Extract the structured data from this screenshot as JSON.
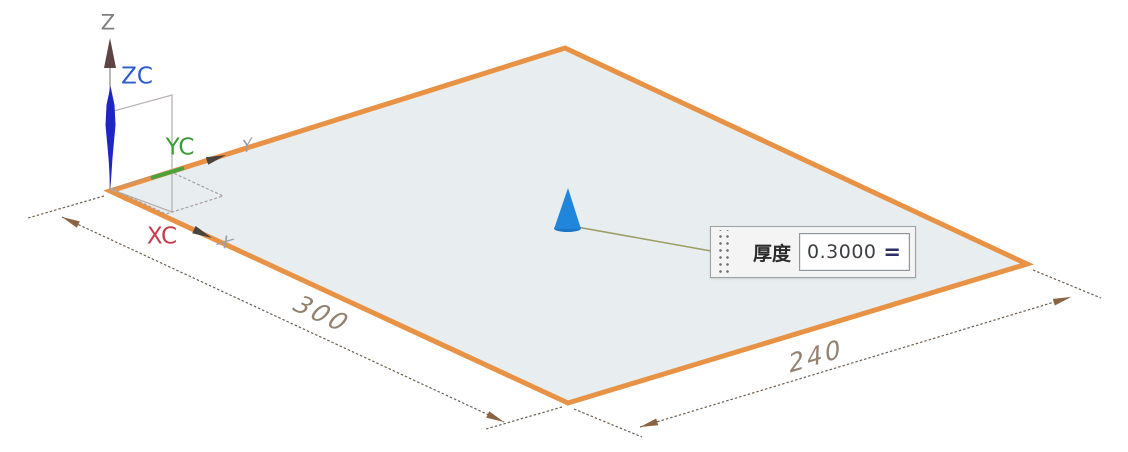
{
  "viewport": {
    "triad": {
      "z_label": "Z",
      "zc_label": "ZC",
      "yc_label": "YC",
      "xc_label": "XC",
      "y_axis_glyph": "Y",
      "x_axis_glyph": "X"
    },
    "dimensions": {
      "left_edge_value": "300",
      "right_edge_value": "240"
    },
    "thickness": {
      "label": "厚度",
      "value": "0.3000",
      "formula_toggle": "="
    },
    "colors": {
      "sheet_fill": "#e8edef",
      "sheet_edge": "#e89245",
      "direction_handle_blue": "#1f86db",
      "z_handle_blue": "#1f25c5",
      "zc_label": "#2d5bd1",
      "yc_label": "#3d9b35",
      "xc_label": "#c63c4b",
      "dim_line": "#70604f",
      "dim_text": "#94826f"
    }
  }
}
